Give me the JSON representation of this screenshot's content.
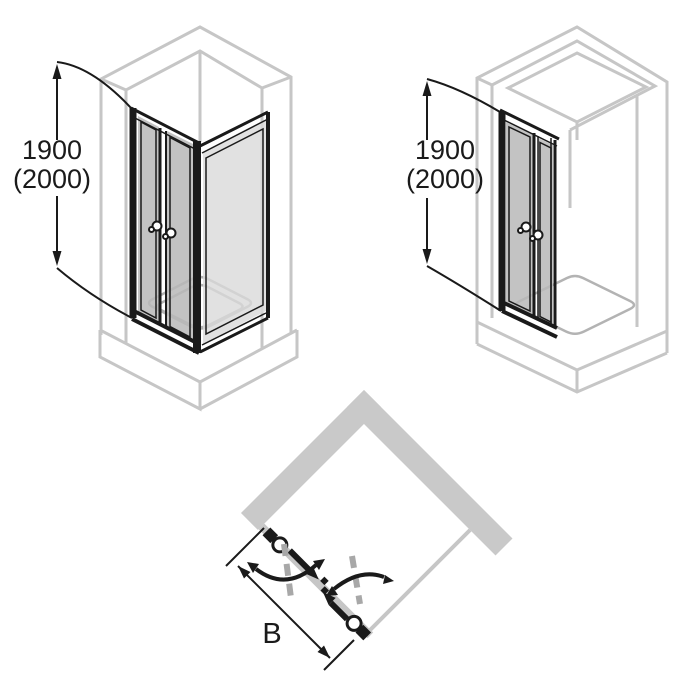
{
  "diagram": {
    "title": "shower-swing-door-dimension-diagram",
    "figure_corner": {
      "label_height_1": "1900",
      "label_height_2": "(2000)"
    },
    "figure_niche": {
      "label_height_1": "1900",
      "label_height_2": "(2000)"
    },
    "figure_plan": {
      "label_width": "B"
    }
  },
  "colors": {
    "line_black": "#1a1a1a",
    "wall_gray": "#c6c6c6",
    "wall_fill": "#c9c9c9",
    "dash_gray": "#a8a8a8",
    "tray_gray": "#b3b3b3"
  }
}
